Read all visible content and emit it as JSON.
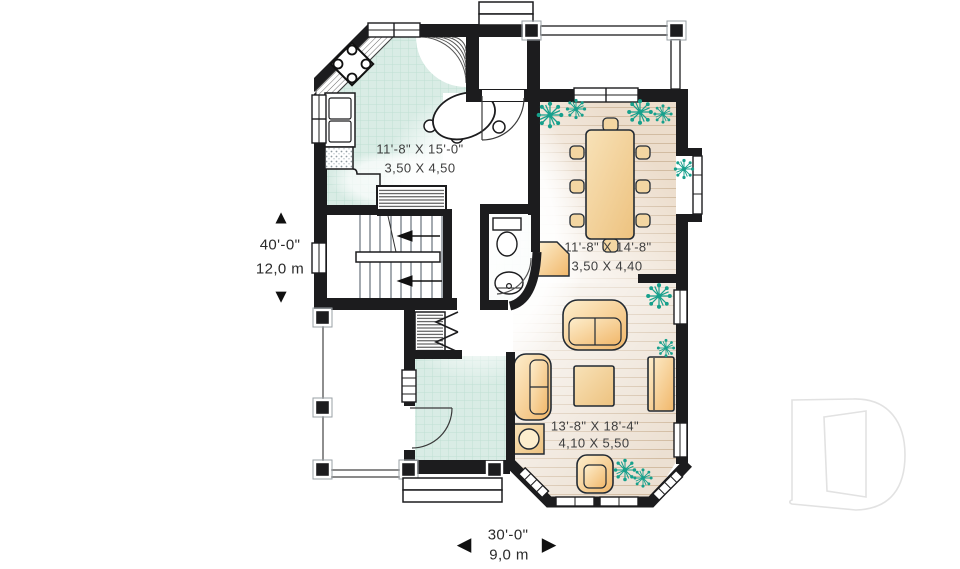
{
  "rooms": {
    "kitchen": {
      "imperial": "11'-8\" X 15'-0\"",
      "metric": "3,50 X 4,50"
    },
    "dining": {
      "imperial": "11'-8\" X 14'-8\"",
      "metric": "3,50 X 4,40"
    },
    "living": {
      "imperial": "13'-8\" X 18'-4\"",
      "metric": "4,10 X 5,50"
    }
  },
  "dimensions": {
    "height": {
      "imperial": "40'-0\"",
      "metric": "12,0 m"
    },
    "width": {
      "imperial": "30'-0\"",
      "metric": "9,0 m"
    }
  },
  "icons": {
    "up_arrow": "▲",
    "down_arrow": "▼",
    "left_arrow": "◀",
    "right_arrow": "▶",
    "logo": "letter-d-outline-watermark"
  },
  "colors": {
    "wall": "#1c1c1e",
    "tile_floor": "#d9ece5",
    "wood_floor": "#ecdecd",
    "furniture": "#f1b76a",
    "plant": "#17a08c",
    "logo_outline": "#e2e2e2"
  }
}
